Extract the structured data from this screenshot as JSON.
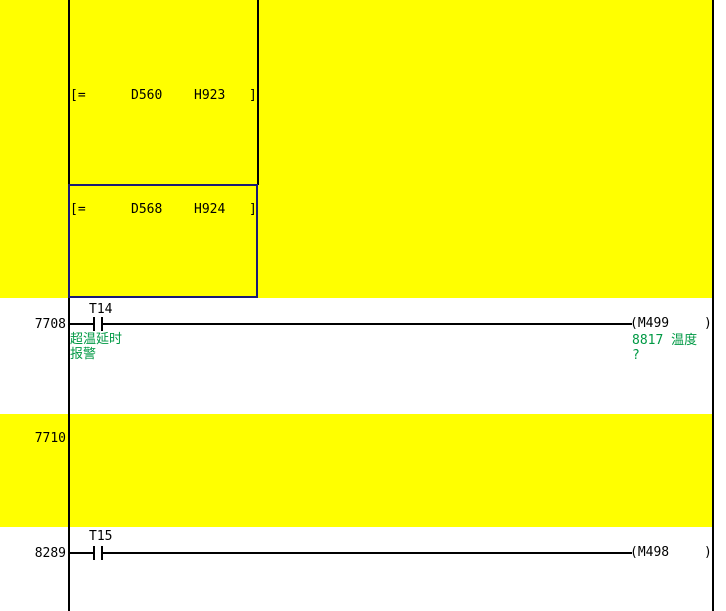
{
  "colors": {
    "highlight": "#ffff00",
    "bg": "#ffffff",
    "wire": "#000000",
    "selection": "#1a1a75",
    "comment": "#009944"
  },
  "compare_blocks": [
    {
      "op": "[=",
      "operand1": "D560",
      "operand2": "H923",
      "close": "]"
    },
    {
      "op": "[=",
      "operand1": "D568",
      "operand2": "H924",
      "close": "]"
    }
  ],
  "rungs": [
    {
      "number": "7708",
      "contact_label": "T14",
      "contact_comment": [
        "超温延时",
        "报警"
      ],
      "coil_label": "(M499",
      "coil_close": ")",
      "coil_comment": [
        "8817 温度",
        "?"
      ]
    },
    {
      "number": "7710"
    },
    {
      "number": "8289",
      "contact_label": "T15",
      "coil_label": "(M498",
      "coil_close": ")"
    }
  ]
}
